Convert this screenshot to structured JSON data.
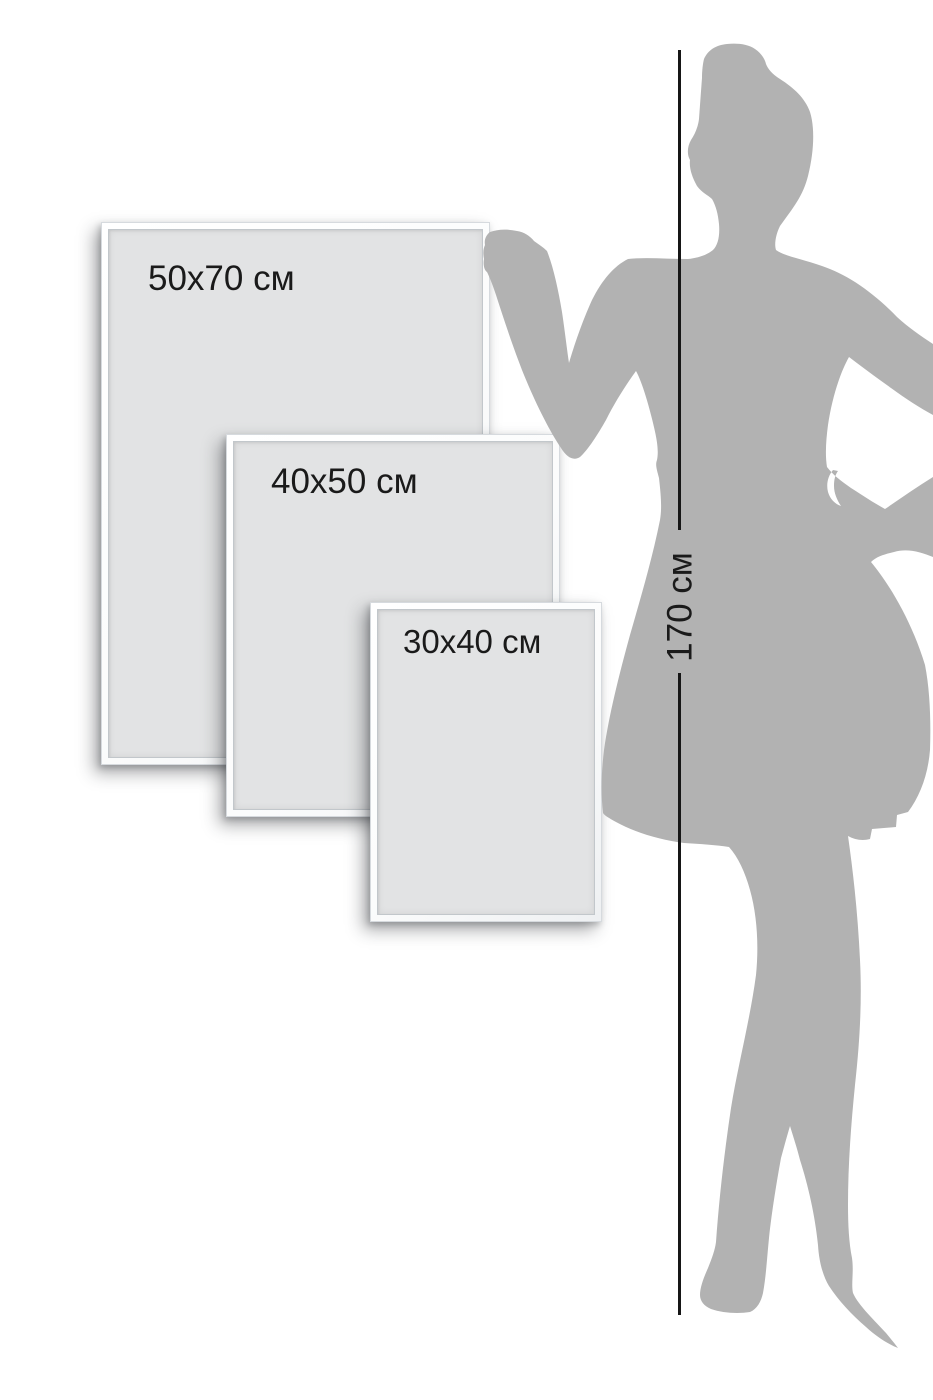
{
  "frames": [
    {
      "label": "50x70 см"
    },
    {
      "label": "40x50 см"
    },
    {
      "label": "30x40 см"
    }
  ],
  "height_marker": {
    "label": "170 см"
  },
  "figure": {
    "description": "woman-silhouette"
  },
  "colors": {
    "background": "#ffffff",
    "silhouette": "#b2b2b2",
    "frame_canvas": "#e2e3e4",
    "frame_border_edge": "#d6dade",
    "measure_line": "#161616",
    "text": "#1a1a1a"
  }
}
